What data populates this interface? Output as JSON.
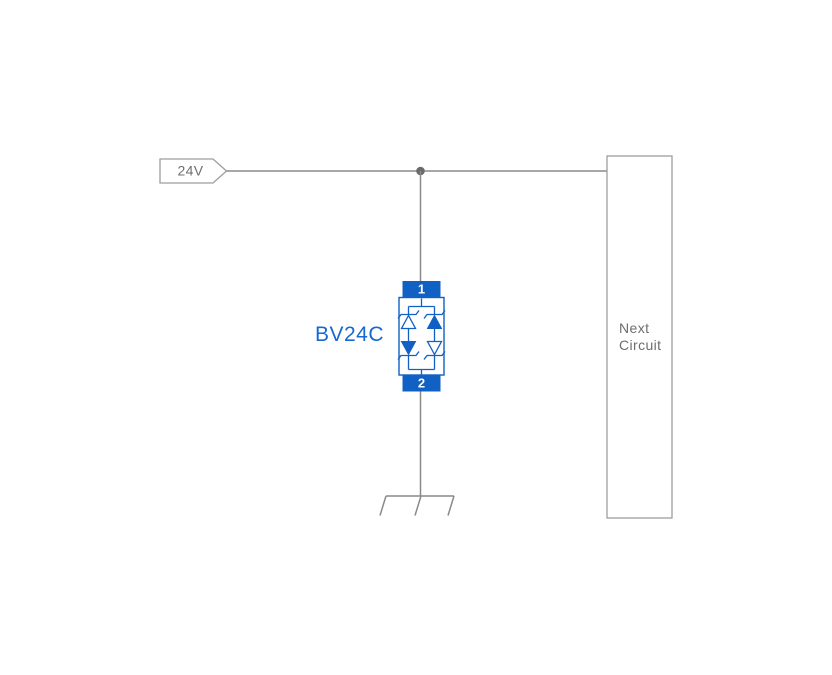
{
  "colors": {
    "background": "#ffffff",
    "wire": "#8a8a8a",
    "outline_gray": "#9e9e9e",
    "junction": "#6b6b6b",
    "label_gray": "#6e6e6e",
    "component_blue": "#1160c4",
    "component_label_blue": "#1668d2",
    "pin_text": "#ffffff"
  },
  "net_label": {
    "text": "24V"
  },
  "component": {
    "name": "BV24C",
    "pin_top": "1",
    "pin_bottom": "2"
  },
  "next_circuit": {
    "line1": "Next",
    "line2": "Circuit"
  }
}
